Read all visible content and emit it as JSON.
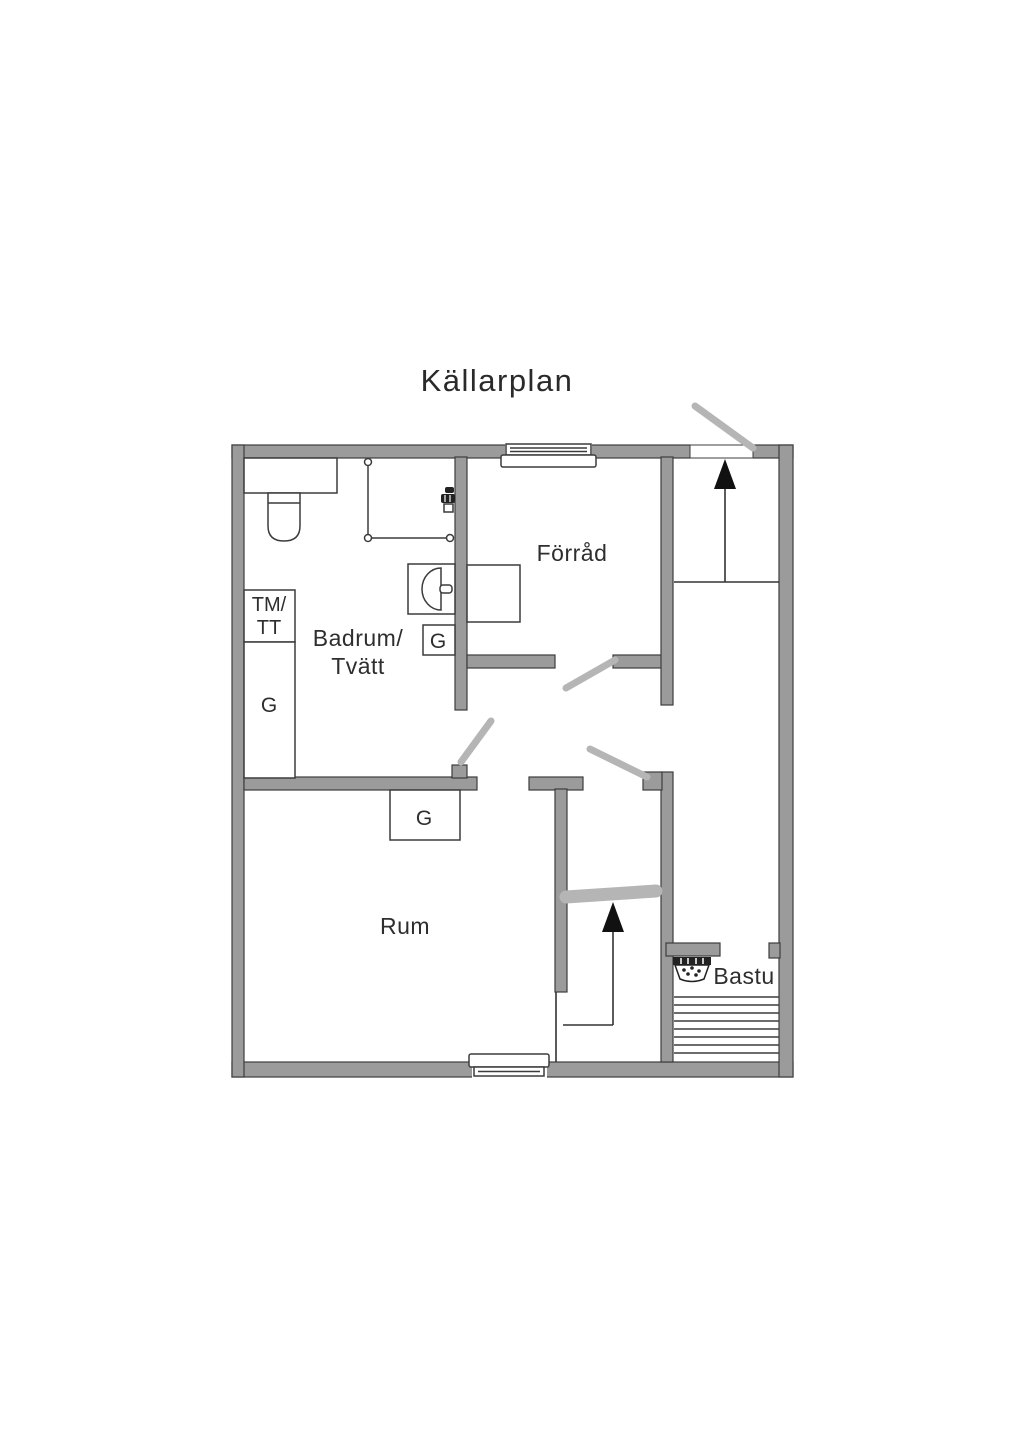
{
  "title": "Källarplan",
  "colors": {
    "background": "#ffffff",
    "wall_fill": "#9b9b9b",
    "wall_outline": "#3d3d3d",
    "thin_line": "#3c3c3c",
    "door_leaf": "#b5b5b5",
    "text": "#2e2e2e",
    "arrow": "#111111"
  },
  "rooms": {
    "badrum_tvatt": {
      "label_line1": "Badrum/",
      "label_line2": "Tvätt"
    },
    "forrad": {
      "label": "Förråd"
    },
    "rum": {
      "label": "Rum"
    },
    "bastu": {
      "label": "Bastu"
    }
  },
  "fixtures": {
    "tm_tt_closet": {
      "label_line1": "TM/",
      "label_line2": "TT"
    },
    "wardrobe_left": {
      "label": "G"
    },
    "wardrobe_bathroom": {
      "label": "G"
    },
    "wardrobe_rum": {
      "label": "G"
    }
  },
  "icons": {
    "stairs_upper": "up-arrow",
    "stairs_lower": "up-arrow",
    "sauna_heater": "stove-with-stones",
    "shower": "shower-mixer",
    "toilet": "toilet-top-view",
    "sink": "washbasin-top-view",
    "window": "double-line-window",
    "door": "swing-leaf"
  }
}
